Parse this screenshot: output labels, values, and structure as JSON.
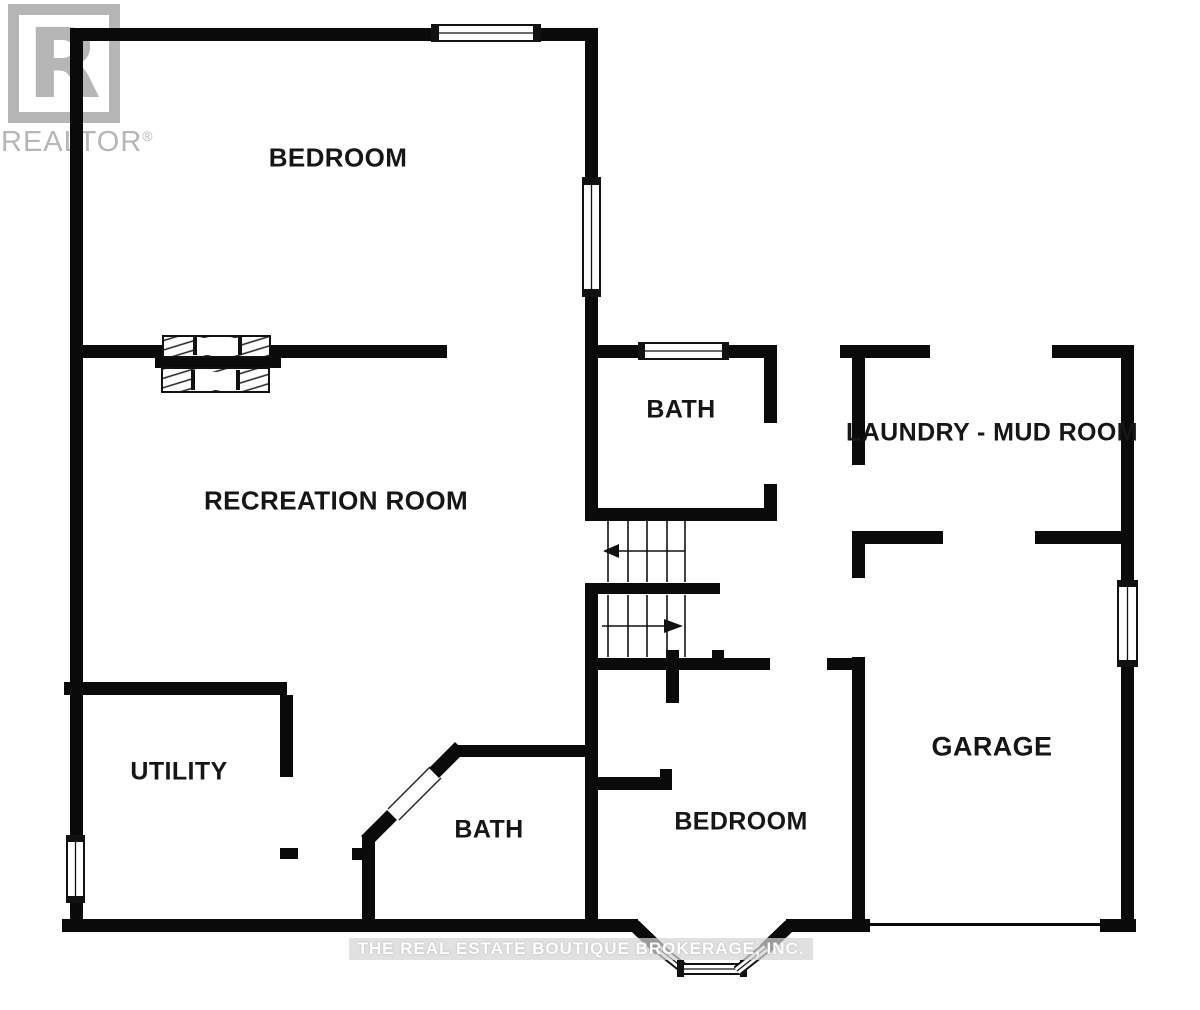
{
  "logo": {
    "letter": "R",
    "brand": "REALTOR",
    "registered": "®"
  },
  "rooms": {
    "bedroom_upper": {
      "label": "BEDROOM"
    },
    "recreation": {
      "label": "RECREATION ROOM"
    },
    "bath_upper": {
      "label": "BATH"
    },
    "laundry": {
      "label": "LAUNDRY - MUD ROOM"
    },
    "garage": {
      "label": "GARAGE"
    },
    "utility": {
      "label": "UTILITY"
    },
    "bath_lower": {
      "label": "BATH"
    },
    "bedroom_lower": {
      "label": "BEDROOM"
    }
  },
  "watermark": {
    "text": "THE REAL ESTATE BOUTIQUE BROKERAGE, INC."
  },
  "stairs": {
    "up_arrow_direction": "left",
    "down_arrow_direction": "right"
  },
  "colors": {
    "wall": "#0a0a0a",
    "logo_gray": "#b6b6b6",
    "watermark_band": "#d6d6d6",
    "watermark_text": "#ffffff",
    "background": "#ffffff"
  }
}
